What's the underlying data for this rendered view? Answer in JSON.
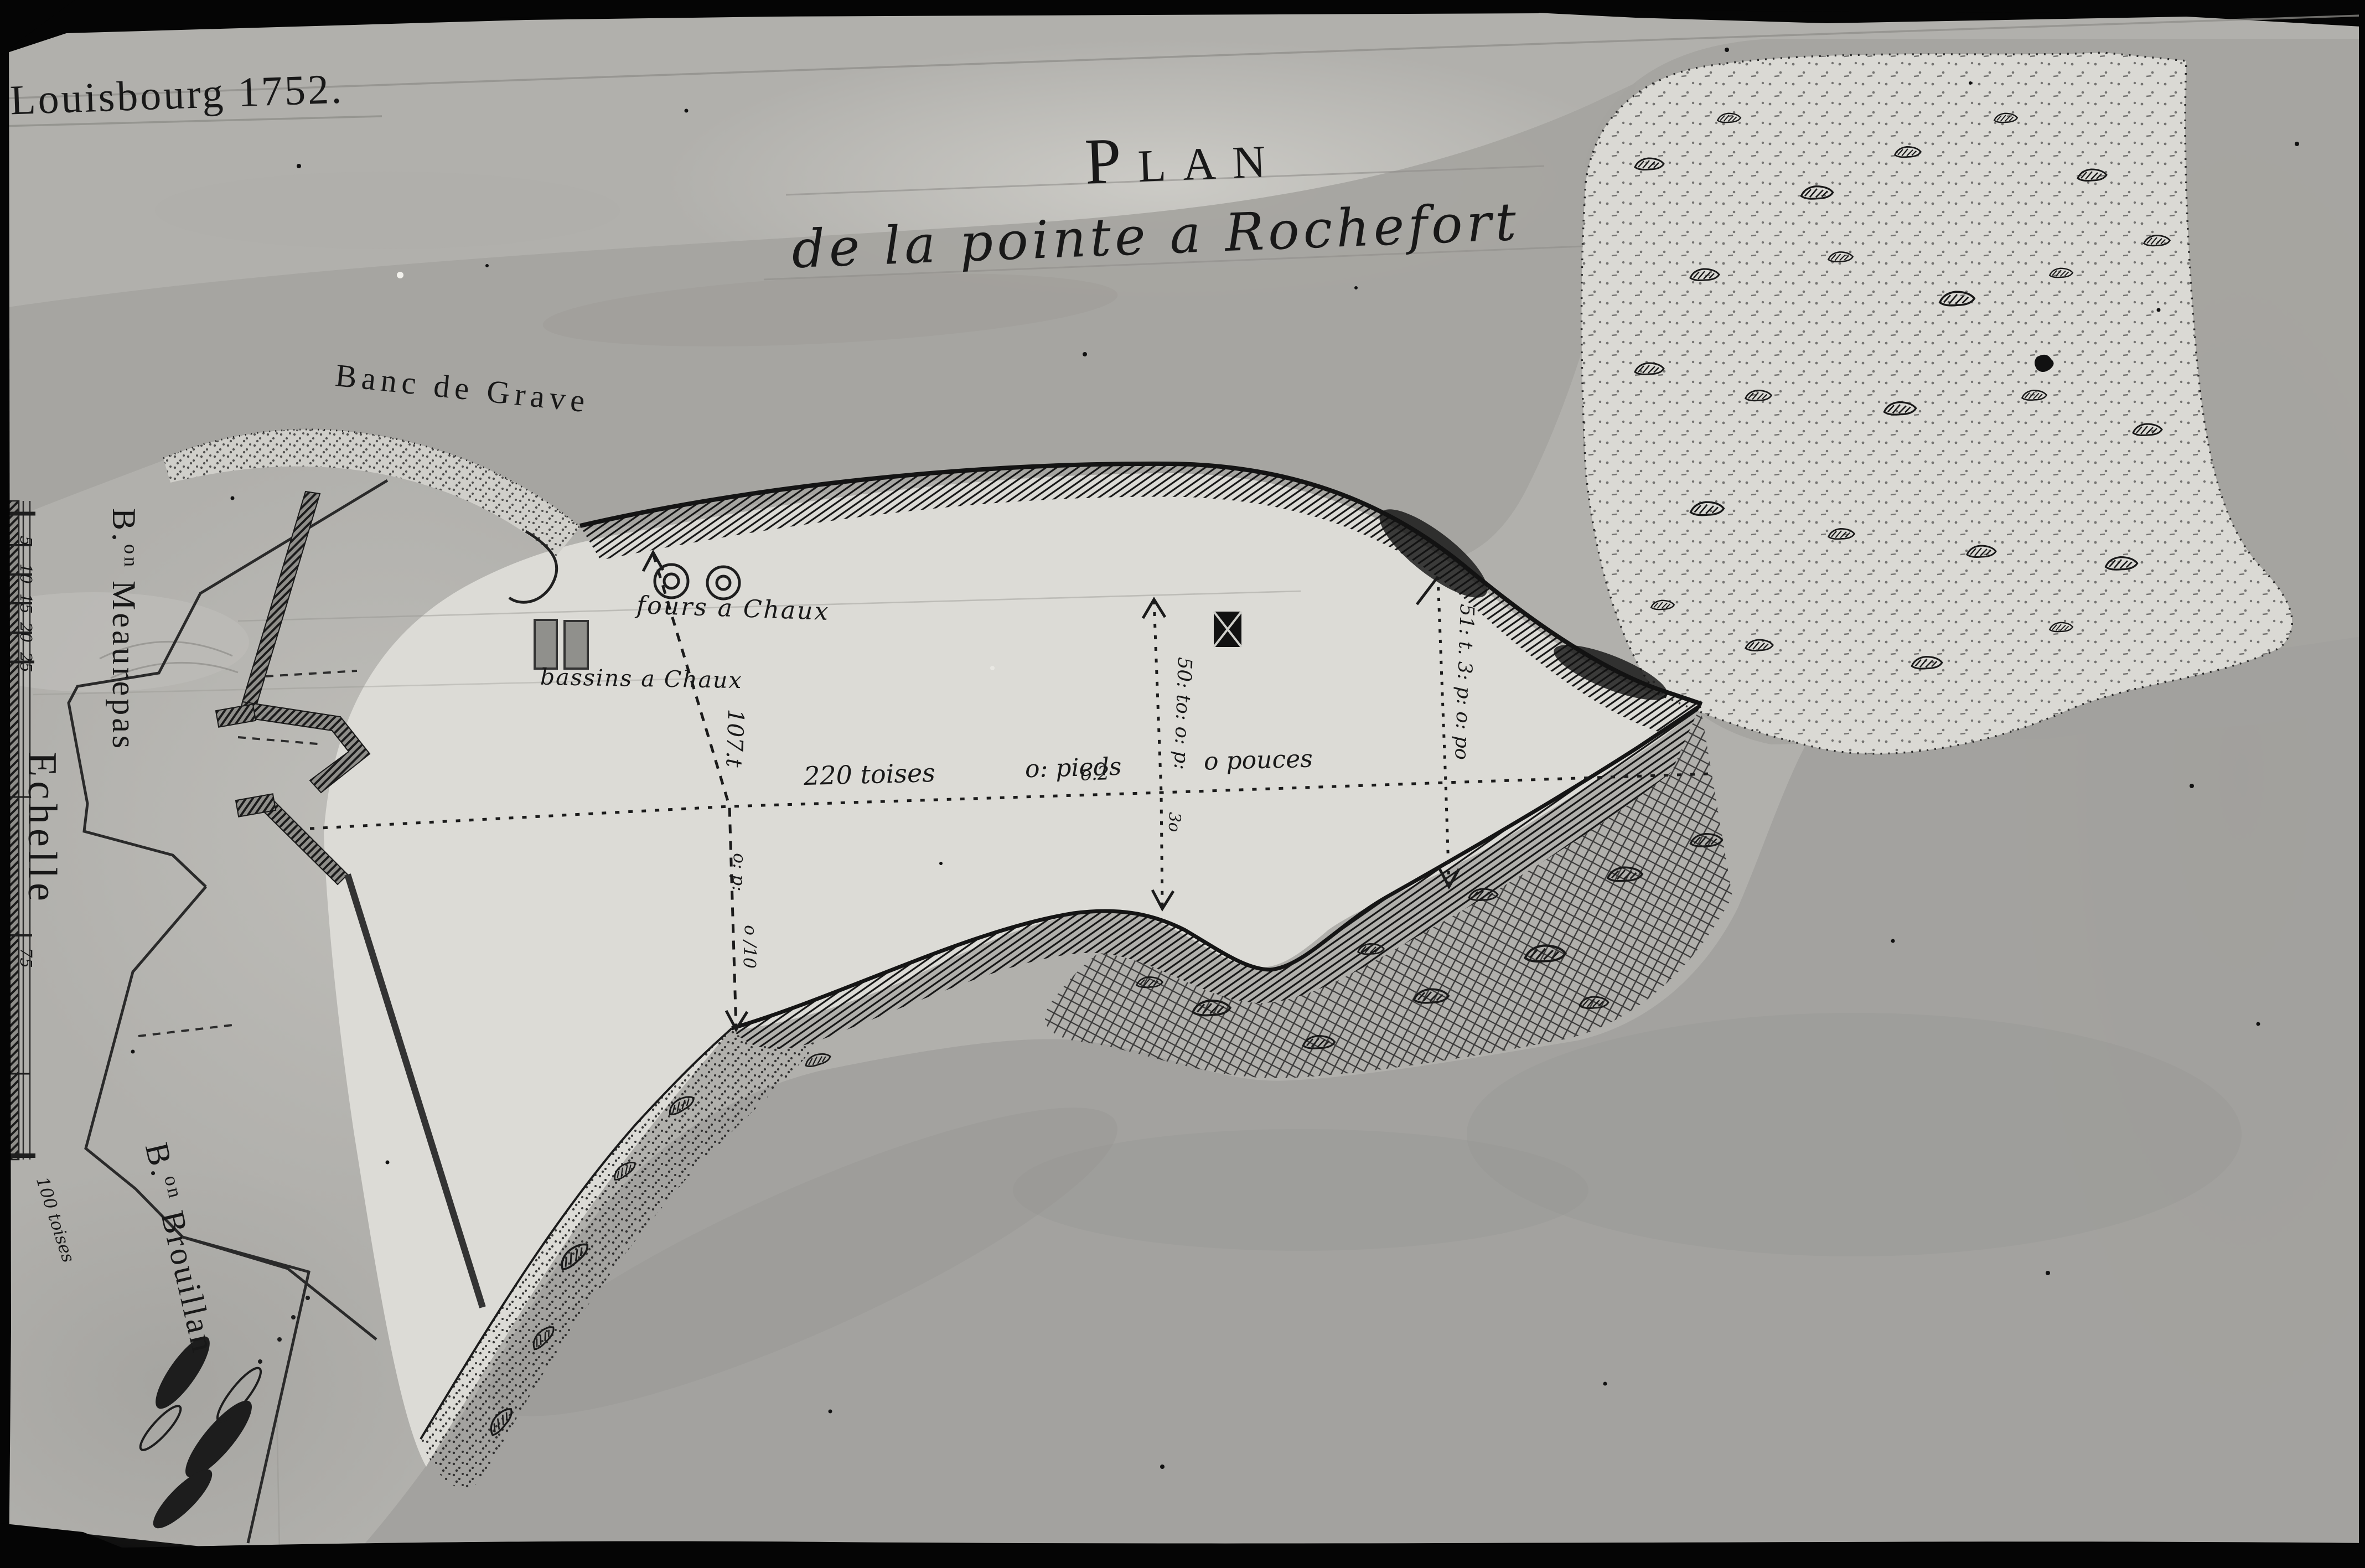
{
  "annotations": {
    "corner_title": "Louisbourg 1752.",
    "map_title": "Plan",
    "map_subtitle": "de la pointe a Rochefort",
    "banc_de_grave": "Banc de Grave",
    "fours_a_chaux": "fours a Chaux",
    "bassins_a_chaux": "bassins a Chaux",
    "bastion_meaurepas": {
      "abbr": "B.",
      "sup": "on",
      "name": "Meaurepas"
    },
    "bastion_brouillan": {
      "abbr": "B.",
      "sup": "on",
      "name": "Brouillan"
    },
    "echelle": "Echelle",
    "scale_bottom_label": "100 toises",
    "scale_ticks": {
      "t5": "5",
      "t10": "10",
      "t15": "15",
      "t20": "20",
      "t25": "25",
      "t75": "75"
    },
    "dim_220": {
      "toises": "220 toises",
      "pieds": "o: pieds",
      "pouces": "o pouces"
    },
    "dim_107": "107.t",
    "dim_50": "50: to: o: p:",
    "dim_51": "51: t. 3: p: o: po",
    "dim_marks": {
      "a": "o: p:",
      "b": "o /10",
      "c": "o.2",
      "d": "3o"
    }
  },
  "map_features": {
    "kilns_icon": "two concentric-circle lime kilns",
    "basins_icon": "two shaded rectangles",
    "redoubt_icon": "black square building",
    "colors": {
      "paper": "#b1b0ac",
      "flat": "#dcdbd6",
      "water": "#a3a29e",
      "ink": "#1a1a1a",
      "frame": "#050505"
    }
  }
}
